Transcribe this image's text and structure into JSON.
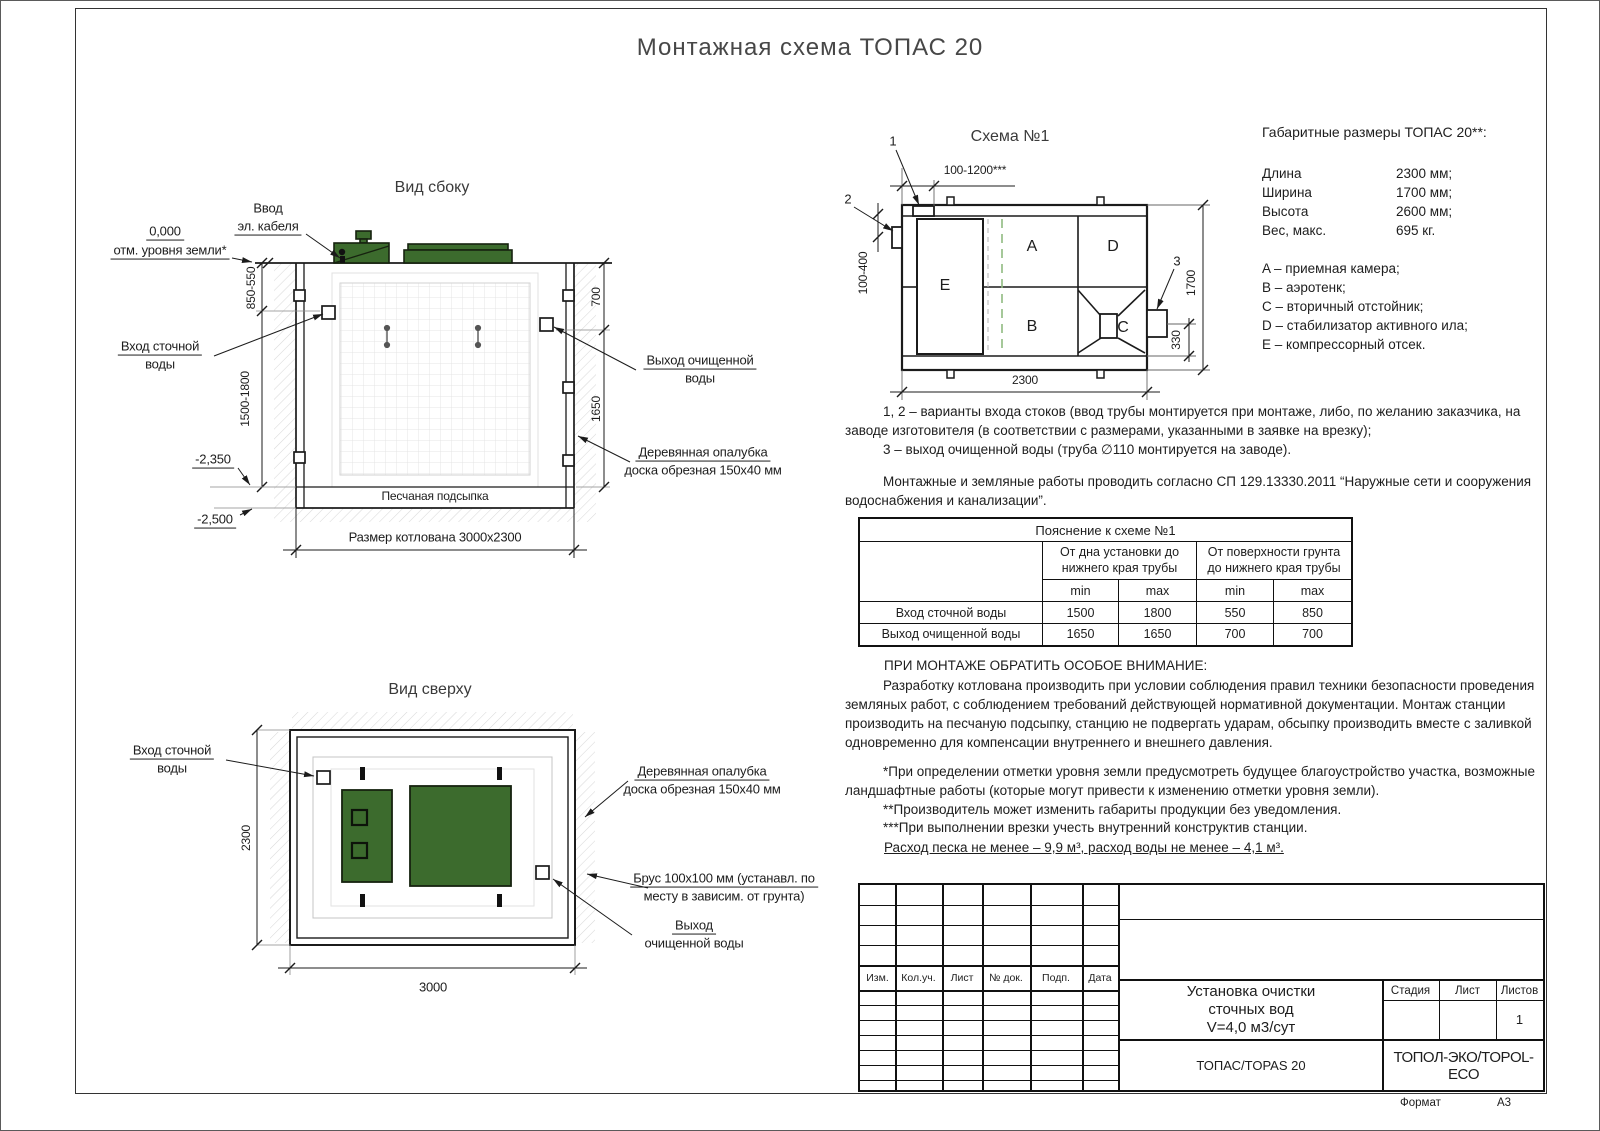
{
  "page": {
    "title": "Монтажная схема ТОПАС 20",
    "format_label": "Формат",
    "format_value": "А3"
  },
  "side_view": {
    "title": "Вид сбоку",
    "cable_l1": "Ввод",
    "cable_l2": "эл. кабеля",
    "ground_l1": "0,000",
    "ground_l2": "отм. уровня земли*",
    "inlet_l1": "Вход сточной",
    "inlet_l2": "воды",
    "outlet_l1": "Выход очищенной",
    "outlet_l2": "воды",
    "formwork_l1": "Деревянная опалубка",
    "formwork_l2": "доска обрезная 150х40 мм",
    "sand": "Песчаная подсыпка",
    "pit": "Размер котлована 3000х2300",
    "lvl_2350": "-2,350",
    "lvl_2500": "-2,500",
    "d850": "850-550",
    "d1500": "1500-1800",
    "d700": "700",
    "d1650": "1650"
  },
  "top_view": {
    "title": "Вид сверху",
    "inlet_l1": "Вход сточной",
    "inlet_l2": "воды",
    "formwork_l1": "Деревянная опалубка",
    "formwork_l2": "доска обрезная 150х40 мм",
    "beam_l1": "Брус 100х100 мм (устанавл. по",
    "beam_l2": "месту в зависим. от грунта)",
    "outlet_l1": "Выход",
    "outlet_l2": "очищенной воды",
    "d2300": "2300",
    "d3000": "3000"
  },
  "schema": {
    "title": "Схема №1",
    "a": "A",
    "b": "B",
    "c": "C",
    "d": "D",
    "e": "E",
    "m1": "1",
    "m2": "2",
    "m3": "3",
    "d_top": "100-1200***",
    "d_left": "100-400",
    "d_right": "1700",
    "d_330": "330",
    "d_bottom": "2300"
  },
  "dims_block": {
    "title": "Габаритные размеры ТОПАС 20**:",
    "rows": [
      {
        "label": "Длина",
        "value": "2300 мм;"
      },
      {
        "label": "Ширина",
        "value": "1700 мм;"
      },
      {
        "label": "Высота",
        "value": "2600 мм;"
      },
      {
        "label": "Вес, макс.",
        "value": "695 кг."
      }
    ],
    "legend": [
      "A – приемная камера;",
      "B – аэротенк;",
      "C – вторичный отстойник;",
      "D – стабилизатор активного ила;",
      "E – компрессорный отсек."
    ]
  },
  "notes": {
    "p1": "1, 2 – варианты входа  стоков (ввод трубы монтируется при монтаже, либо, по желанию заказчика, на заводе изготовителя (в соответствии с размерами, указанными в заявке на врезку);",
    "p2": "3 – выход очищенной воды (труба ∅110 монтируется на заводе).",
    "p3": "Монтажные и земляные работы проводить согласно СП 129.13330.2011 “Наружные сети и сооружения водоснабжения и канализации”."
  },
  "table": {
    "title": "Пояснение к схеме №1",
    "g1": "От дна установки до нижнего края трубы",
    "g2": "От поверхности грунта до нижнего края трубы",
    "min1": "min",
    "max1": "max",
    "min2": "min",
    "max2": "max",
    "rows": [
      {
        "label": "Вход сточной воды",
        "v1": "1500",
        "v2": "1800",
        "v3": "550",
        "v4": "850"
      },
      {
        "label": "Выход очищенной воды",
        "v1": "1650",
        "v2": "1650",
        "v3": "700",
        "v4": "700"
      }
    ]
  },
  "attention": {
    "heading": "ПРИ МОНТАЖЕ ОБРАТИТЬ ОСОБОЕ ВНИМАНИЕ:",
    "body": "Разработку котлована производить при условии соблюдения правил техники безопасности проведения земляных работ, с соблюдением требований действующей нормативной документации. Монтаж станции производить на песчаную подсыпку, станцию не подвергать ударам, обсыпку производить вместе с заливкой одновременно для компенсации внутреннего и внешнего давления."
  },
  "footnotes": {
    "f1": "*При определении отметки уровня земли предусмотреть будущее благоустройство участка, возможные ландшафтные работы (которые могут привести к изменению отметки уровня земли).",
    "f2": "**Производитель может изменить габариты продукции без уведомления.",
    "f3": "***При выполнении врезки учесть внутренний конструктив станции.",
    "consumption": "Расход песка не менее – 9,9 м³, расход воды не менее – 4,1 м³."
  },
  "stamp": {
    "cols": [
      "Изм.",
      "Кол.уч.",
      "Лист",
      "№ док.",
      "Подп.",
      "Дата"
    ],
    "title_l1": "Установка очистки",
    "title_l2": "сточных вод",
    "title_l3": "V=4,0 м3/сут",
    "stage": "Стадия",
    "sheet": "Лист",
    "sheets": "Листов",
    "sheets_value": "1",
    "model": "ТОПАС/TOPAS 20",
    "company": "ТОПОЛ-ЭКО/TOPOL-ECO"
  },
  "colors": {
    "lid_green": "#3c6b2d",
    "dash_green": "#8fbb80",
    "line": "#1b1b1b"
  }
}
